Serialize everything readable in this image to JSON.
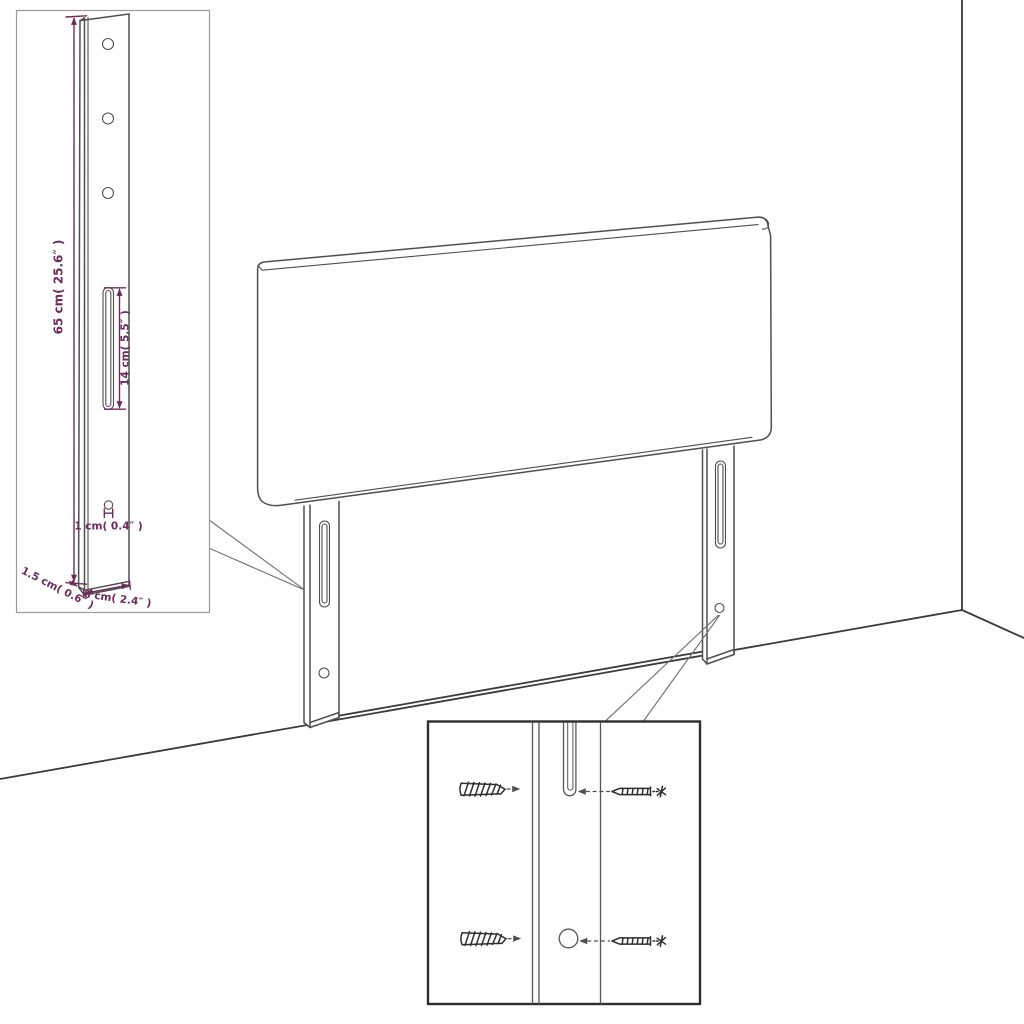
{
  "inset_leg_detail": {
    "dim_height": "65 cm( 25.6″ )",
    "dim_slot_length": "14 cm( 5.5″ )",
    "dim_hole_diameter": "1 cm( 0.4″ )",
    "dim_side_depth": "1.5 cm( 0.6″ )",
    "dim_bottom_width": "6 cm( 2.4″ )"
  },
  "colors": {
    "dimension": "#6d2b5c",
    "line": "#555555",
    "line-dark": "#2f2f2f",
    "wall": "#3a3a3a",
    "inset-border": "#9b9b9b",
    "detail-border": "#2e2e2e",
    "background": "#ffffff"
  }
}
